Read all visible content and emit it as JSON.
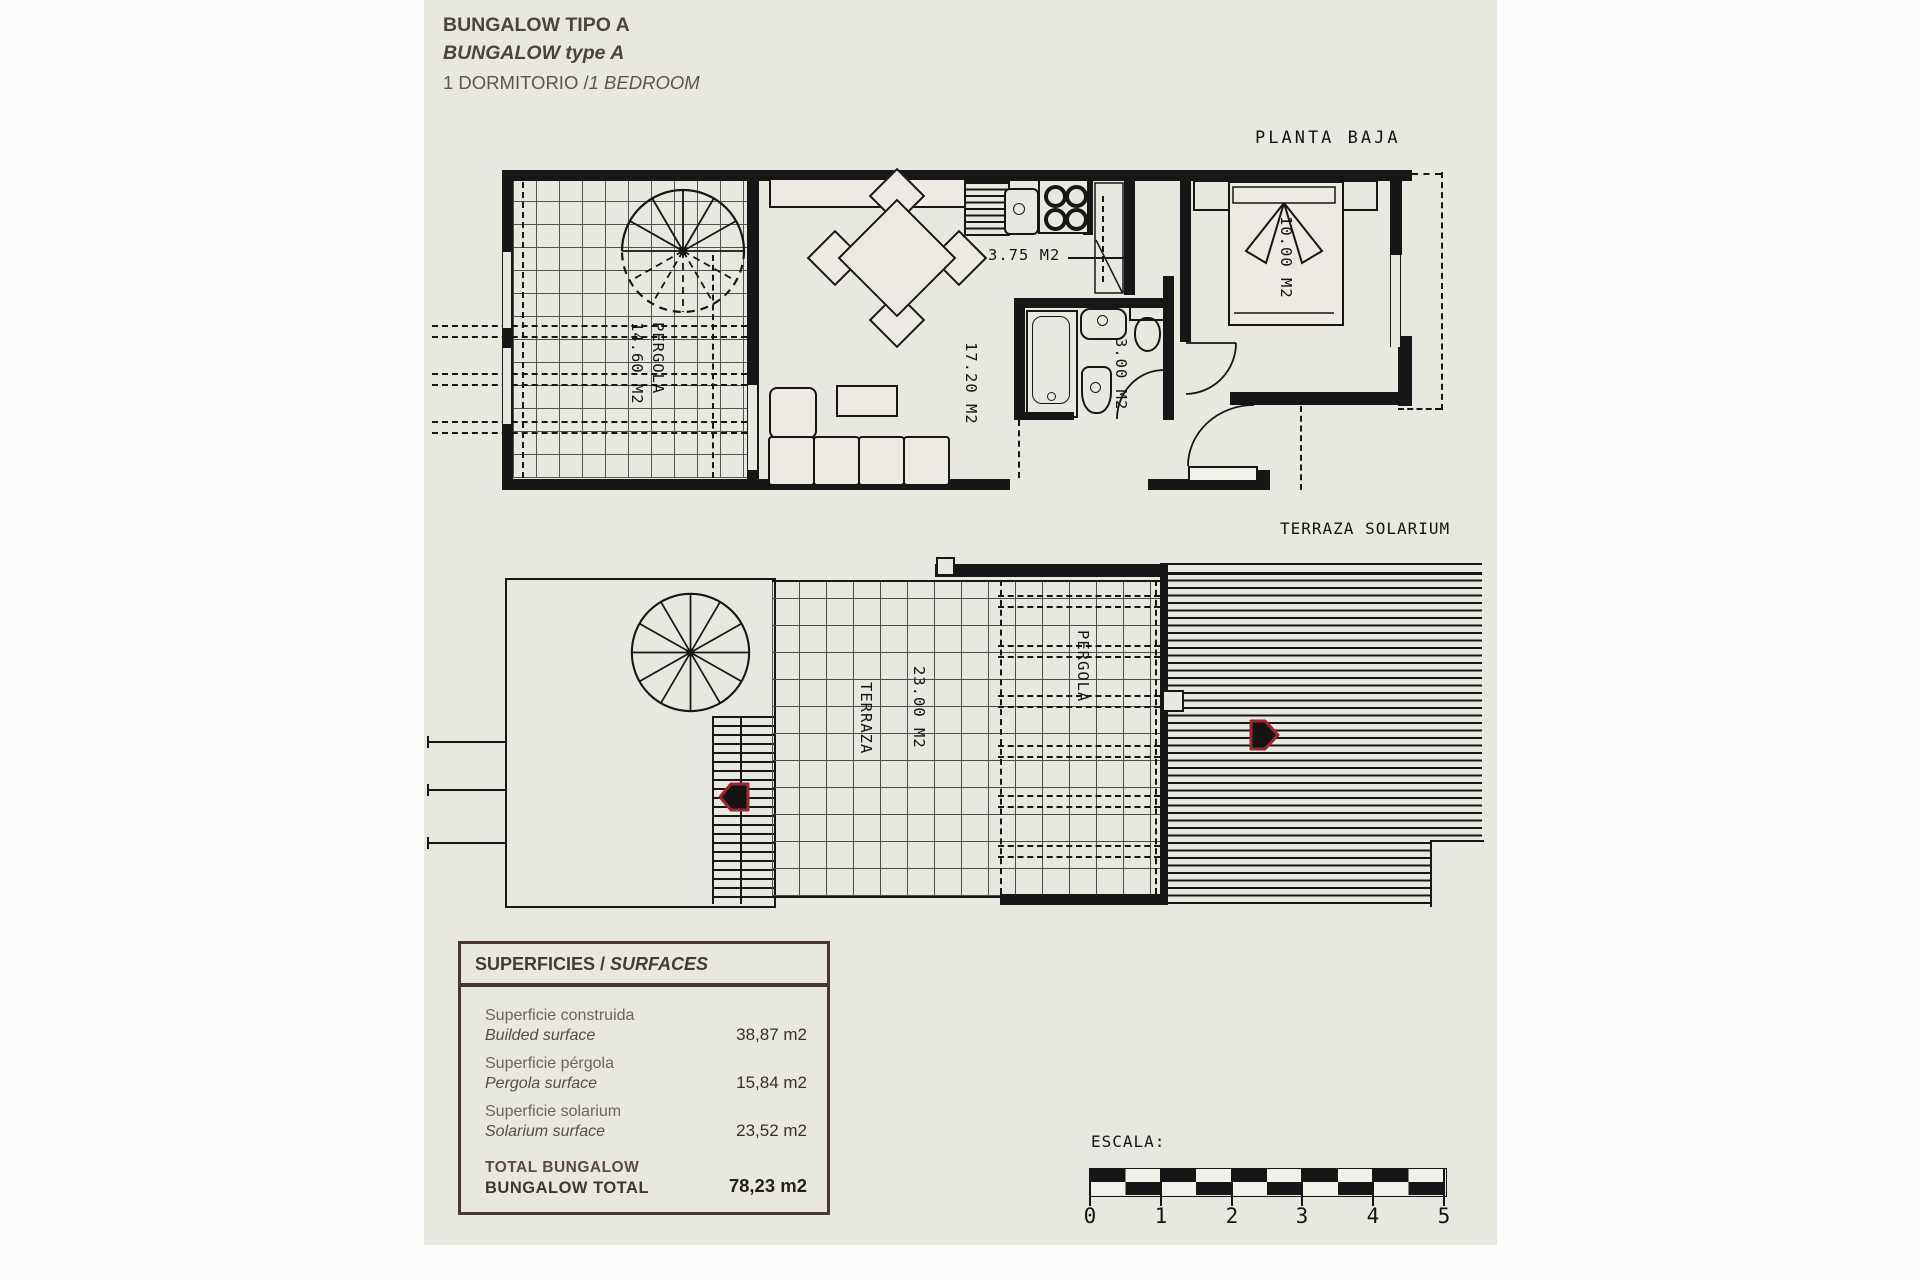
{
  "colors": {
    "sheet": "#e9e8e0",
    "ink": "#161616",
    "table_brown": "#4a3833",
    "marker_red": "#9e2433"
  },
  "title_block": {
    "line1": "BUNGALOW TIPO A",
    "line2": "BUNGALOW type A",
    "line3_regular": "1 DORMITORIO /",
    "line3_italic": "1 BEDROOM"
  },
  "ground_floor": {
    "caption": "PLANTA BAJA",
    "pergola_name": "PERGOLA",
    "pergola_area": "14.60 M2",
    "living_area": "17.20 M2",
    "kitchen_area": "3.75 M2",
    "bathroom_area": "3.00 M2",
    "bedroom_area": "10.00 M2"
  },
  "roof_floor": {
    "caption": "TERRAZA SOLARIUM",
    "terrace_name": "TERRAZA",
    "terrace_area": "23.00 M2",
    "pergola_name": "PERGOLA"
  },
  "surfaces_table": {
    "header_regular": "SUPERFICIES /",
    "header_italic": "SURFACES",
    "rows": [
      {
        "es": "Superficie construida",
        "en": "Builded surface",
        "value": "38,87 m2"
      },
      {
        "es": "Superficie pérgola",
        "en": "Pergola surface",
        "value": "15,84 m2"
      },
      {
        "es": "Superficie solarium",
        "en": "Solarium surface",
        "value": "23,52 m2"
      }
    ],
    "total": {
      "es": "TOTAL BUNGALOW",
      "en": "BUNGALOW TOTAL",
      "value": "78,23 m2"
    }
  },
  "scale_bar": {
    "label": "ESCALA:",
    "ticks": [
      "0",
      "1",
      "2",
      "3",
      "4",
      "5"
    ]
  }
}
